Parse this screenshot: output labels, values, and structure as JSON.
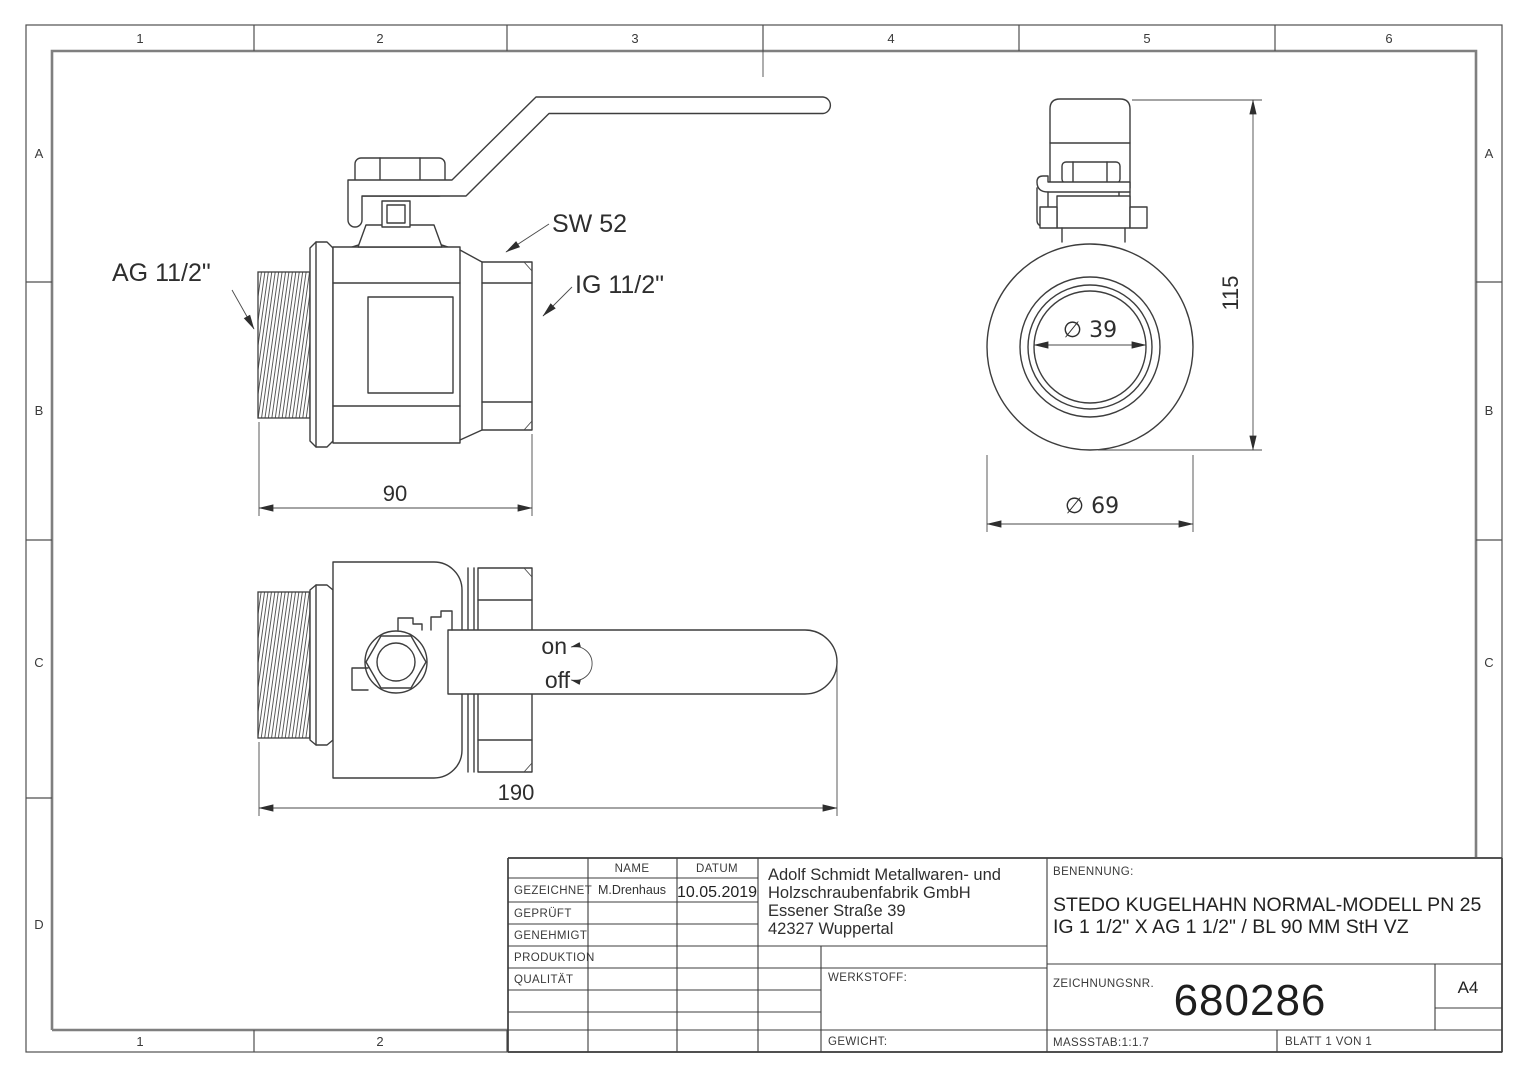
{
  "colors": {
    "line": "#3d3d3d",
    "inner_frame": "#7f7f7f",
    "text": "#333333"
  },
  "sheet": {
    "top_columns": [
      "1",
      "2",
      "3",
      "4",
      "5",
      "6"
    ],
    "bottom_columns": [
      "1",
      "2"
    ],
    "left_rows": [
      "A",
      "B",
      "C",
      "D"
    ],
    "right_rows": [
      "A",
      "B",
      "C"
    ]
  },
  "front_view": {
    "label_ag": "AG 11/2\"",
    "label_sw": "SW 52",
    "label_ig": "IG 11/2\"",
    "dim_length": "90"
  },
  "side_view": {
    "dim_bore": "∅ 39",
    "dim_height": "115",
    "dim_outer": "∅ 69"
  },
  "top_view": {
    "label_on": "on",
    "label_off": "off",
    "dim_length": "190"
  },
  "titleblock": {
    "col_name": "NAME",
    "col_datum": "DATUM",
    "rows": [
      {
        "label": "GEZEICHNET",
        "name": "M.Drenhaus",
        "datum": "10.05.2019"
      },
      {
        "label": "GEPRÜFT",
        "name": "",
        "datum": ""
      },
      {
        "label": "GENEHMIGT",
        "name": "",
        "datum": ""
      },
      {
        "label": "PRODUKTION",
        "name": "",
        "datum": ""
      },
      {
        "label": "QUALITÄT",
        "name": "",
        "datum": ""
      }
    ],
    "company": [
      "Adolf Schmidt Metallwaren- und",
      "Holzschraubenfabrik GmbH",
      "Essener Straße 39",
      "42327 Wuppertal"
    ],
    "werkstoff": "WERKSTOFF:",
    "gewicht": "GEWICHT:",
    "benennung": "BENENNUNG:",
    "title_line1": "STEDO KUGELHAHN NORMAL-MODELL PN 25",
    "title_line2": "IG 1 1/2\" X AG 1 1/2\" / BL 90 MM StH VZ",
    "zeichnungsnr_label": "ZEICHNUNGSNR.",
    "zeichnungsnr": "680286",
    "format": "A4",
    "massstab": "MASSSTAB:1:1.7",
    "blatt": "BLATT 1 VON 1"
  }
}
